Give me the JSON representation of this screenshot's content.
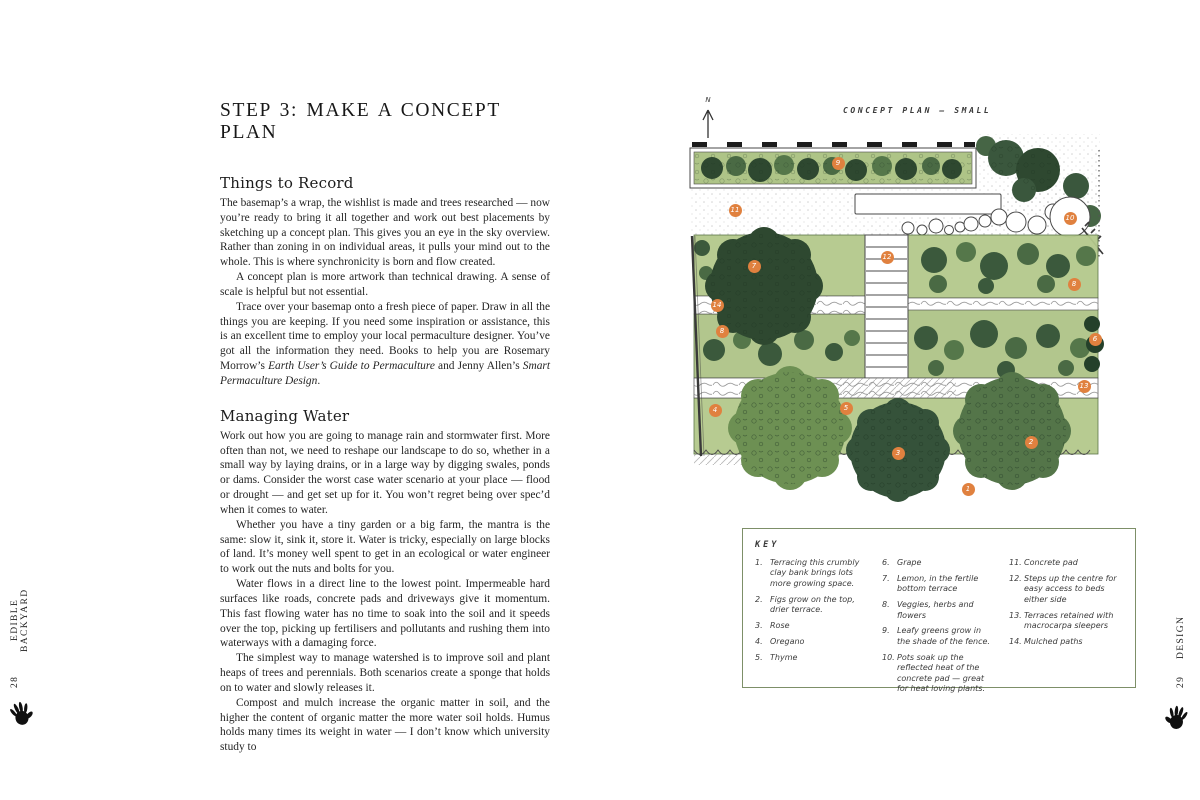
{
  "page_left": {
    "title": "STEP 3: MAKE A CONCEPT PLAN",
    "sections": [
      {
        "heading": "Things to Record",
        "paragraphs": [
          [
            {
              "t": "The basemap’s a wrap, the wishlist is made and trees researched — now you’re ready to bring it all together and work out best placements by sketching up a concept plan. This gives you an eye in the sky overview. Rather than zoning in on individual areas, it pulls your mind out to the whole. This is where synchronicity is born and flow created.",
              "i": false
            }
          ],
          [
            {
              "t": "A concept plan is more artwork than technical drawing. A sense of scale is helpful but not essential.",
              "i": false
            }
          ],
          [
            {
              "t": "Trace over your basemap onto a fresh piece of paper. Draw in all the things you are keeping. If you need some inspiration or assistance, this is an excellent time to employ your local permaculture designer. You’ve got all the information they need. Books to help you are Rosemary Morrow’s ",
              "i": false
            },
            {
              "t": "Earth User’s Guide to Permaculture",
              "i": true
            },
            {
              "t": " and Jenny Allen’s ",
              "i": false
            },
            {
              "t": "Smart Permaculture Design",
              "i": true
            },
            {
              "t": ".",
              "i": false
            }
          ]
        ]
      },
      {
        "heading": "Managing Water",
        "paragraphs": [
          [
            {
              "t": "Work out how you are going to manage rain and stormwater first. More often than not, we need to reshape our landscape to do so, whether in a small way by laying drains, or in a large way by digging swales, ponds or dams. Consider the worst case water scenario at your place — flood or drought — and get set up for it. You won’t regret being over spec’d when it comes to water.",
              "i": false
            }
          ],
          [
            {
              "t": "Whether you have a tiny garden or a big farm, the mantra is the same: slow it, sink it, store it. Water is tricky, especially on large blocks of land. It’s money well spent to get in an ecological or water engineer to work out the nuts and bolts for you.",
              "i": false
            }
          ],
          [
            {
              "t": "Water flows in a direct line to the lowest point. Impermeable hard surfaces like roads, concrete pads and driveways give it momentum. This fast flowing water has no time to soak into the soil and it speeds over the top, picking up fertilisers and pollutants and rushing them into waterways with a damaging force.",
              "i": false
            }
          ],
          [
            {
              "t": "The simplest way to manage watershed is to improve soil and plant heaps of trees and perennials. Both scenarios create a sponge that holds on to water and slowly releases it.",
              "i": false
            }
          ],
          [
            {
              "t": "Compost and mulch increase the organic matter in soil, and the higher the content of organic matter the more water soil holds. Humus holds many times its weight in water — I don’t know which university study to",
              "i": false
            }
          ]
        ]
      }
    ],
    "spine_label": "EDIBLE BACKYARD",
    "page_number": "28"
  },
  "page_right": {
    "north_label": "N",
    "plan_title": "CONCEPT PLAN — SMALL",
    "plan": {
      "markers": [
        {
          "n": "9",
          "x": 152,
          "y": 35
        },
        {
          "n": "11",
          "x": 49,
          "y": 82
        },
        {
          "n": "10",
          "x": 384,
          "y": 90
        },
        {
          "n": "7",
          "x": 68,
          "y": 138
        },
        {
          "n": "12",
          "x": 201,
          "y": 129
        },
        {
          "n": "8",
          "x": 388,
          "y": 156
        },
        {
          "n": "14",
          "x": 31,
          "y": 177
        },
        {
          "n": "8",
          "x": 36,
          "y": 203
        },
        {
          "n": "6",
          "x": 409,
          "y": 211
        },
        {
          "n": "13",
          "x": 398,
          "y": 258
        },
        {
          "n": "4",
          "x": 29,
          "y": 282
        },
        {
          "n": "5",
          "x": 160,
          "y": 280
        },
        {
          "n": "3",
          "x": 212,
          "y": 325
        },
        {
          "n": "2",
          "x": 345,
          "y": 314
        },
        {
          "n": "1",
          "x": 282,
          "y": 361
        }
      ]
    },
    "key": {
      "title": "KEY",
      "columns": [
        [
          {
            "num": "1.",
            "text": "Terracing this crumbly clay bank brings lots more growing space."
          },
          {
            "num": "2.",
            "text": "Figs grow on the top, drier terrace."
          },
          {
            "num": "3.",
            "text": "Rose"
          },
          {
            "num": "4.",
            "text": "Oregano"
          },
          {
            "num": "5.",
            "text": "Thyme"
          }
        ],
        [
          {
            "num": "6.",
            "text": "Grape"
          },
          {
            "num": "7.",
            "text": "Lemon, in the fertile bottom terrace"
          },
          {
            "num": "8.",
            "text": "Veggies, herbs and flowers"
          },
          {
            "num": "9.",
            "text": "Leafy greens grow in the shade of the fence."
          },
          {
            "num": "10.",
            "text": "Pots soak up the reflected heat of the concrete pad — great for heat loving plants."
          }
        ],
        [
          {
            "num": "11.",
            "text": "Concrete pad"
          },
          {
            "num": "12.",
            "text": "Steps up the centre for easy access to beds either side"
          },
          {
            "num": "13.",
            "text": "Terraces retained with macrocarpa sleepers"
          },
          {
            "num": "14.",
            "text": "Mulched paths"
          }
        ]
      ]
    },
    "spine_label": "DESIGN",
    "page_number": "29"
  },
  "palette": {
    "marker_orange": "#e0813f",
    "key_border": "#7d8f68",
    "bed_green": "#b4c98c",
    "foliage_dark": "#2e4830",
    "foliage_mid": "#55774a",
    "foliage_light": "#8fb068",
    "ink": "#222222"
  }
}
